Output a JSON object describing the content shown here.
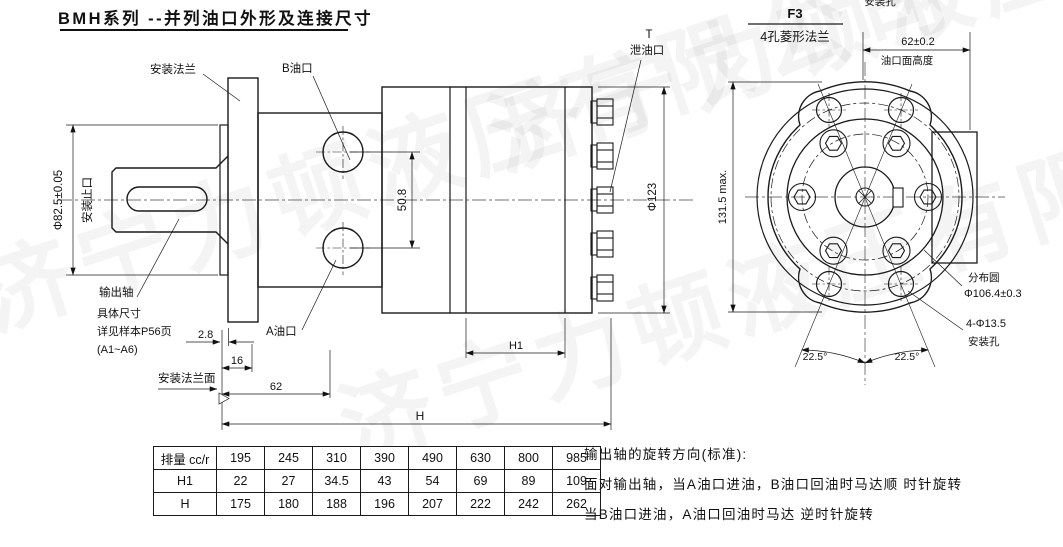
{
  "title": {
    "text": "BMH系列 --并列油口外形及连接尺寸"
  },
  "watermark": {
    "text": "济宁力顿液压有限公司"
  },
  "side_view": {
    "labels": {
      "mounting_flange": "安装法兰",
      "port_b": "B油口",
      "port_a": "A油口",
      "drain_code": "T",
      "drain_port": "泄油口",
      "output_shaft": "输出轴",
      "shaft_note_line1": "具体尺寸",
      "shaft_note_line2": "详见样本P56页",
      "shaft_note_line3": "(A1~A6)",
      "mounting_flange_face": "安装法兰面"
    },
    "dims": {
      "spigot_diameter": "Φ82.5±0.05",
      "spigot_name": "安装止口",
      "port_spacing": "50.8",
      "body_diameter": "Φ123",
      "flange_step": "2.8",
      "flange_thickness": "16",
      "port_face_distance": "62",
      "total_length": "H",
      "rear_length": "H1"
    }
  },
  "front_view": {
    "heading": {
      "code": "F3",
      "name": "4孔菱形法兰"
    },
    "top_clipped_label": "安装孔",
    "dims": {
      "overall_height": "131.5 max.",
      "port_face_height": "62±0.2",
      "port_face_height_label": "油口面高度",
      "pitch_circle_label": "分布圆",
      "pitch_circle_value": "Φ106.4±0.3",
      "mounting_holes_value": "4-Φ13.5",
      "mounting_holes_label": "安装孔",
      "angle_left": "22.5°",
      "angle_right": "22.5°"
    }
  },
  "table": {
    "rows": [
      {
        "label": "排量 cc/r",
        "values": [
          "195",
          "245",
          "310",
          "390",
          "490",
          "630",
          "800",
          "985"
        ]
      },
      {
        "label": "H1",
        "values": [
          "22",
          "27",
          "34.5",
          "43",
          "54",
          "69",
          "89",
          "109"
        ]
      },
      {
        "label": "H",
        "values": [
          "175",
          "180",
          "188",
          "196",
          "207",
          "222",
          "242",
          "262"
        ]
      }
    ]
  },
  "notes": {
    "line1": "输出轴的旋转方向(标准):",
    "line2": "面对输出轴，当A油口进油，B油口回油时马达顺 时针旋转",
    "line3": "当B油口进油，A油口回油时马达 逆时针旋转"
  }
}
